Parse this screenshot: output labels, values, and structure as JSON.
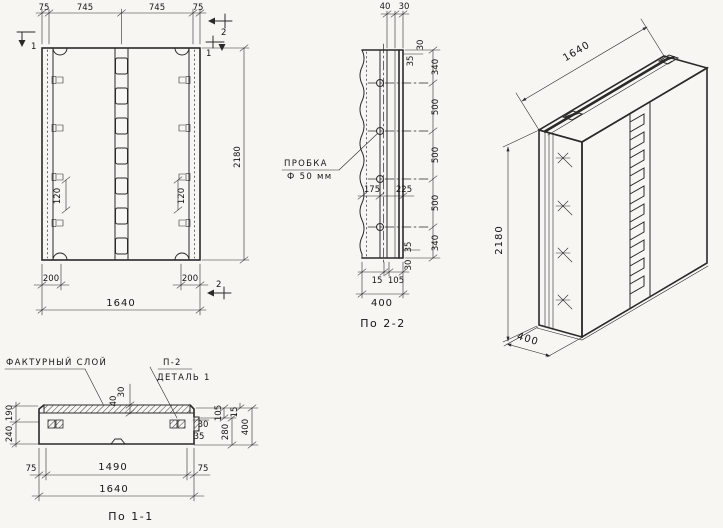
{
  "drawing": {
    "front_view": {
      "dims_top": [
        "75",
        "745",
        "745",
        "75"
      ],
      "dim_height": "2180",
      "dims_anchor": [
        "120",
        "120"
      ],
      "dims_bottom_small": [
        "200",
        "200"
      ],
      "dim_width": "1640",
      "marker_one": "1",
      "marker_two": "2"
    },
    "section_2_2": {
      "title": "По 2-2",
      "dims_top": [
        "40",
        "30"
      ],
      "dims_edge_top": [
        "30",
        "35"
      ],
      "dims_right": [
        "340",
        "500",
        "500",
        "500",
        "340"
      ],
      "dims_edge_bottom": [
        "35",
        "30"
      ],
      "dims_middle": [
        "175",
        "225"
      ],
      "dims_bottom": [
        "15",
        "105"
      ],
      "dim_width": "400",
      "callout_plug_line1": "ПРОБКА",
      "callout_plug_line2": "Ф 50 мм"
    },
    "iso_view": {
      "dim_width": "1640",
      "dim_height": "2180",
      "dim_depth": "400"
    },
    "section_1_1": {
      "title": "По 1-1",
      "label_layer": "ФАКТУРНЫЙ СЛОЙ",
      "label_detail_ref": "П-2",
      "label_detail": "ДЕТАЛЬ 1",
      "dims_left": [
        "190",
        "240"
      ],
      "dims_layer": [
        "30",
        "40"
      ],
      "dims_right_small": [
        "30",
        "35"
      ],
      "dims_right": [
        "105",
        "15",
        "280",
        "400"
      ],
      "dims_bottom": [
        "75",
        "1490",
        "75"
      ],
      "dim_width": "1640"
    }
  }
}
